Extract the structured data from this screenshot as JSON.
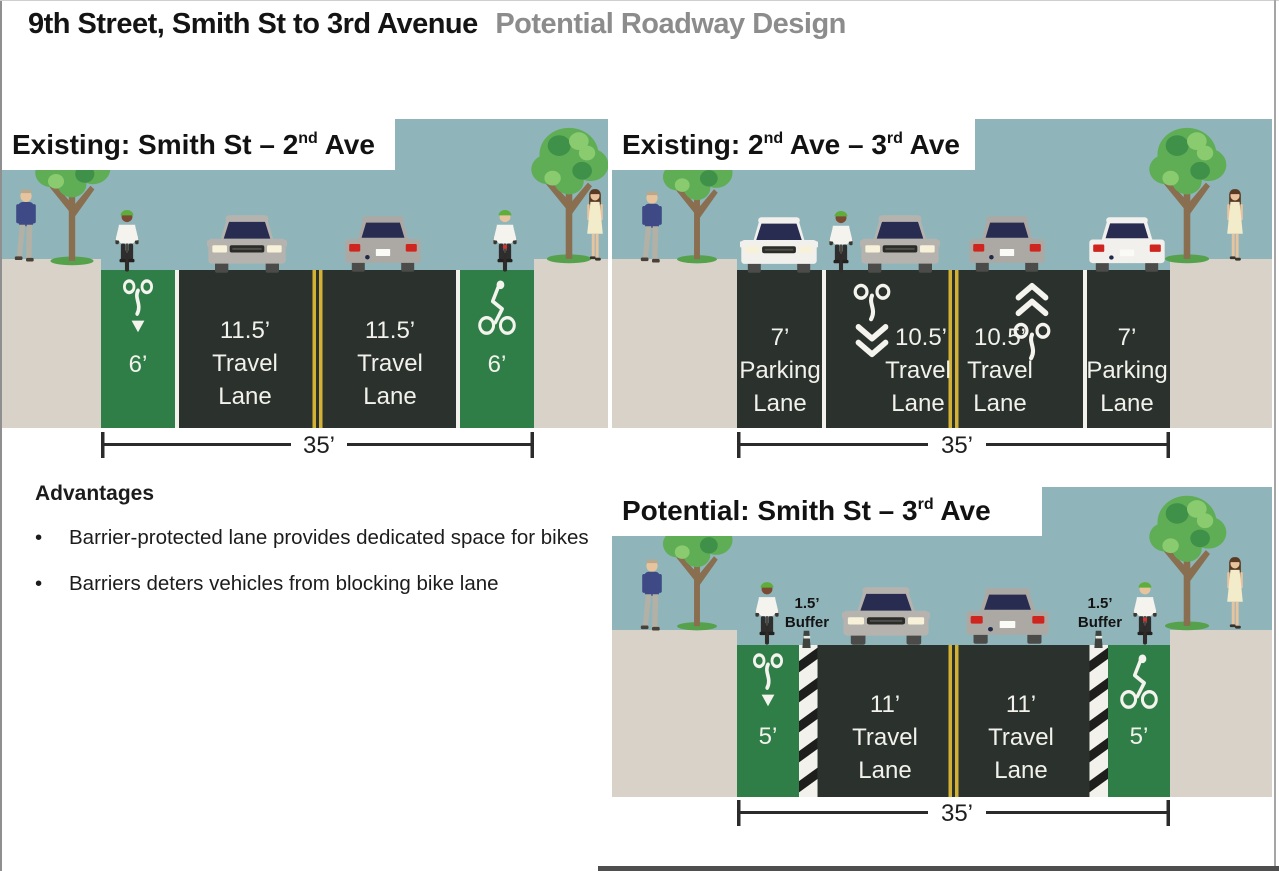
{
  "page": {
    "title": "9th Street, Smith St to 3rd Avenue",
    "subtitle": "Potential Roadway Design"
  },
  "colors": {
    "sky": "#8FB5BA",
    "sidewalk": "#D8D2C8",
    "road": "#2B322E",
    "bike_lane": "#2F7E48",
    "yellow_line": "#D2B135",
    "white_line": "#F2F1EC",
    "lane_text": "#F2F1EC",
    "title_gray": "#8C8C8C",
    "foliage": "#5FAE55",
    "trunk": "#8A6E50"
  },
  "advantages": {
    "heading": "Advantages",
    "bullet_char": "•",
    "bullets": [
      "Barrier-protected lane provides dedicated space for bikes",
      "Barriers deters vehicles from blocking bike lane"
    ]
  },
  "panels": {
    "existing_smith_2nd": {
      "title": {
        "p1": "Existing: Smith St – 2",
        "sup1": "nd",
        "p2": " Ave"
      },
      "bike_left": {
        "width": "6’"
      },
      "travel_left": {
        "l1": "11.5’",
        "l2": "Travel",
        "l3": "Lane"
      },
      "travel_right": {
        "l1": "11.5’",
        "l2": "Travel",
        "l3": "Lane"
      },
      "bike_right": {
        "width": "6’"
      },
      "total_width": "35’"
    },
    "existing_2nd_3rd": {
      "title": {
        "p1": "Existing: 2",
        "sup1": "nd",
        "p2": " Ave – 3",
        "sup2": "rd",
        "p3": " Ave"
      },
      "parking_left": {
        "l1": "7’",
        "l2": "Parking",
        "l3": "Lane"
      },
      "travel_left": {
        "l1": "10.5’",
        "l2": "Travel",
        "l3": "Lane"
      },
      "travel_right": {
        "l1": "10.5’",
        "l2": "Travel",
        "l3": "Lane"
      },
      "parking_right": {
        "l1": "7’",
        "l2": "Parking",
        "l3": "Lane"
      },
      "total_width": "35’"
    },
    "potential_smith_3rd": {
      "title": {
        "p1": "Potential: Smith St – 3",
        "sup1": "rd",
        "p2": " Ave"
      },
      "bike_left": {
        "width": "5’"
      },
      "buffer_left": {
        "l1": "1.5’",
        "l2": "Buffer"
      },
      "travel_left": {
        "l1": "11’",
        "l2": "Travel",
        "l3": "Lane"
      },
      "travel_right": {
        "l1": "11’",
        "l2": "Travel",
        "l3": "Lane"
      },
      "buffer_right": {
        "l1": "1.5’",
        "l2": "Buffer"
      },
      "bike_right": {
        "width": "5’"
      },
      "total_width": "35’"
    }
  },
  "icons": {
    "tree-icon": "stylized street tree shape",
    "pedestrian-man-icon": "man walking figure",
    "pedestrian-woman-icon": "woman walking figure",
    "cyclist-front-icon": "cyclist front view with green helmet",
    "cyclist-rear-icon": "cyclist rear view with green helmet",
    "car-front-icon": "car front view",
    "car-rear-icon": "car rear view",
    "bike-marking-icon": "white bike-lane pavement marking",
    "sharrow-marking-icon": "shared-lane bike + chevron marking",
    "flex-post-icon": "flexible delineator post",
    "buffer-stripes-icon": "hatched buffer stripe band"
  }
}
